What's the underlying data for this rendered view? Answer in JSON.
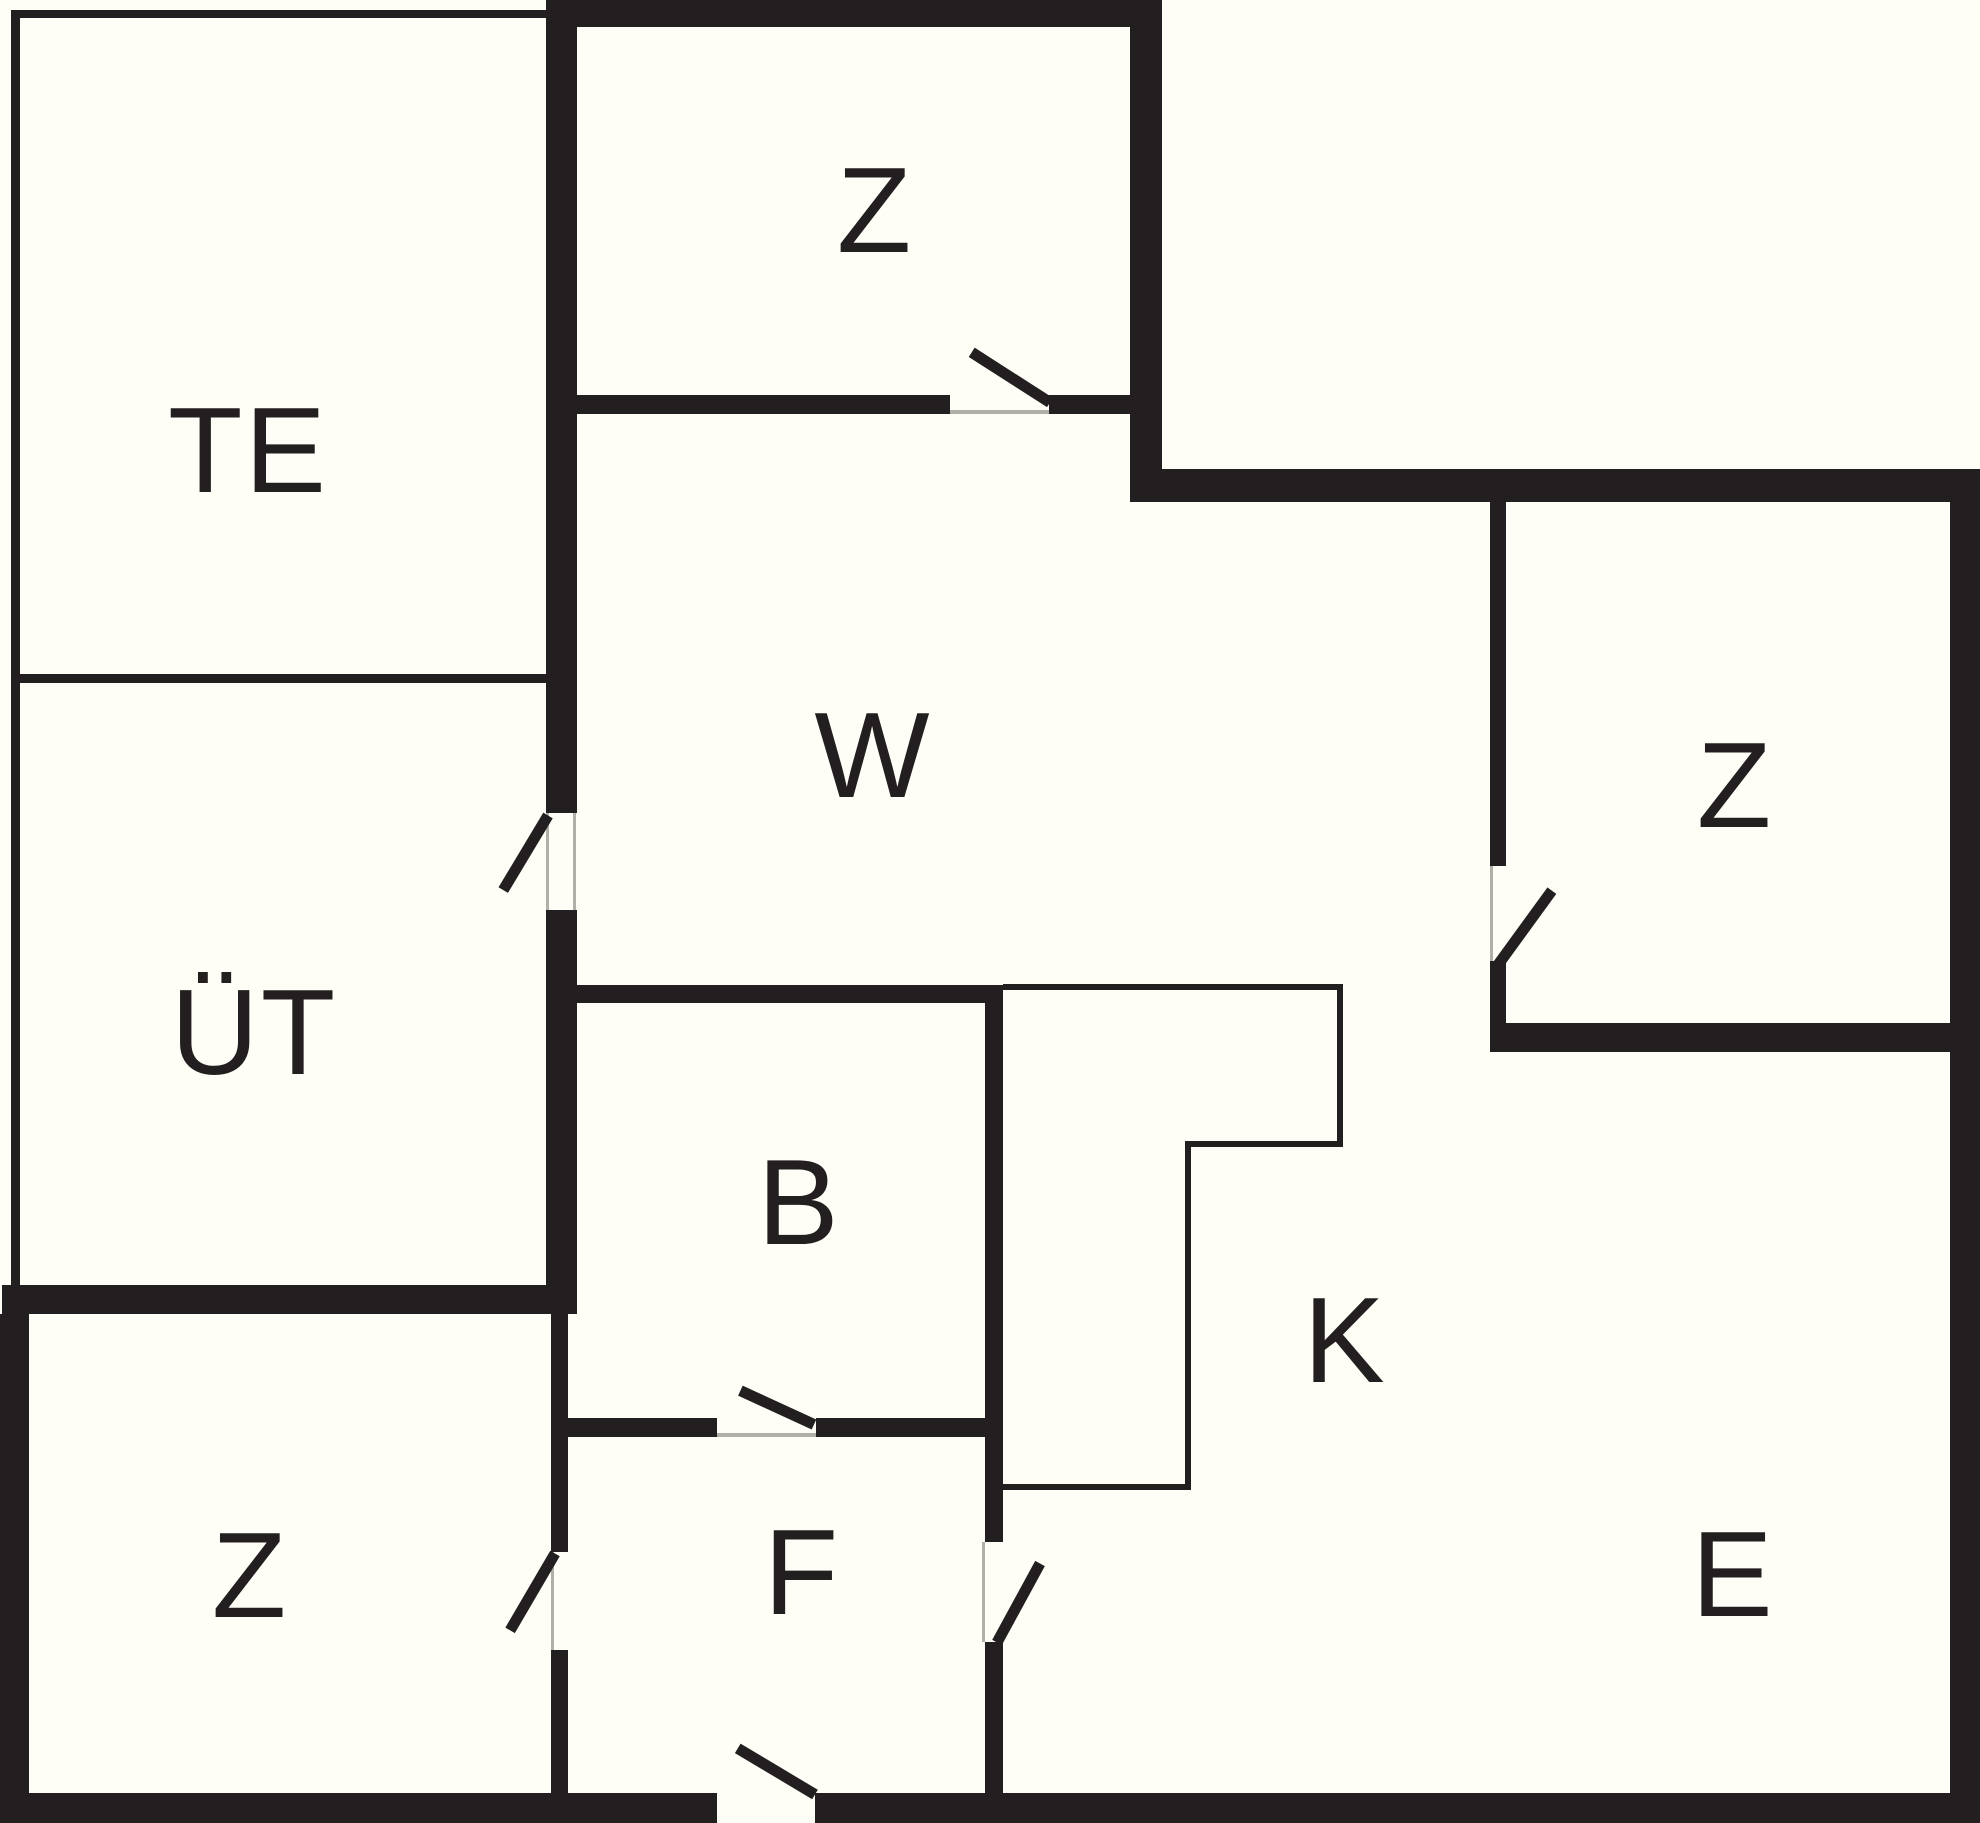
{
  "canvas": {
    "width": 1980,
    "height": 1823,
    "background_color": "#fffef6",
    "ink_color": "#231f20",
    "faint_color": "#b0b0a8",
    "door_swing_thickness": 11
  },
  "rooms": [
    {
      "id": "te",
      "label": "TE",
      "x": 248,
      "y": 450
    },
    {
      "id": "z-top",
      "label": "Z",
      "x": 875,
      "y": 210
    },
    {
      "id": "w",
      "label": "W",
      "x": 873,
      "y": 755
    },
    {
      "id": "z-right",
      "label": "Z",
      "x": 1735,
      "y": 785
    },
    {
      "id": "ut",
      "label": "ÜT",
      "x": 254,
      "y": 1032
    },
    {
      "id": "b",
      "label": "B",
      "x": 799,
      "y": 1202
    },
    {
      "id": "k",
      "label": "K",
      "x": 1345,
      "y": 1340
    },
    {
      "id": "z-bottom",
      "label": "Z",
      "x": 250,
      "y": 1575
    },
    {
      "id": "f",
      "label": "F",
      "x": 802,
      "y": 1572
    },
    {
      "id": "e",
      "label": "E",
      "x": 1733,
      "y": 1574
    }
  ],
  "walls": [
    {
      "name": "outer-wall-top",
      "x": 546,
      "y": 0,
      "w": 616,
      "h": 27
    },
    {
      "name": "wall-te-ztop",
      "x": 546,
      "y": 0,
      "w": 31,
      "h": 813
    },
    {
      "name": "wall-w-left-lower",
      "x": 546,
      "y": 910,
      "w": 31,
      "h": 404
    },
    {
      "name": "wall-ztop-right",
      "x": 1130,
      "y": 0,
      "w": 32,
      "h": 502
    },
    {
      "name": "wall-ztop-bottom-left",
      "x": 577,
      "y": 395,
      "w": 373,
      "h": 19
    },
    {
      "name": "wall-ztop-bottom-right",
      "x": 1049,
      "y": 395,
      "w": 81,
      "h": 19
    },
    {
      "name": "outer-wall-topright",
      "x": 1130,
      "y": 469,
      "w": 850,
      "h": 33
    },
    {
      "name": "outer-wall-right",
      "x": 1950,
      "y": 469,
      "w": 30,
      "h": 1354
    },
    {
      "name": "wall-zright-left-upper",
      "x": 1490,
      "y": 502,
      "w": 16,
      "h": 364
    },
    {
      "name": "wall-zright-left-lower",
      "x": 1490,
      "y": 961,
      "w": 16,
      "h": 91
    },
    {
      "name": "wall-zright-bottom",
      "x": 1490,
      "y": 1023,
      "w": 460,
      "h": 29
    },
    {
      "name": "wall-ut-bottom",
      "x": 2,
      "y": 1285,
      "w": 575,
      "h": 29
    },
    {
      "name": "outer-wall-left-bottom",
      "x": 0,
      "y": 1314,
      "w": 29,
      "h": 509
    },
    {
      "name": "wall-zbottom-f-upper",
      "x": 551,
      "y": 1314,
      "w": 17,
      "h": 238
    },
    {
      "name": "wall-zbottom-f-lower",
      "x": 551,
      "y": 1650,
      "w": 17,
      "h": 143
    },
    {
      "name": "wall-b-top",
      "x": 577,
      "y": 985,
      "w": 426,
      "h": 18
    },
    {
      "name": "wall-b-right",
      "x": 985,
      "y": 985,
      "w": 18,
      "h": 557
    },
    {
      "name": "wall-f-right-lower",
      "x": 985,
      "y": 1642,
      "w": 18,
      "h": 151
    },
    {
      "name": "wall-b-bottom-left",
      "x": 568,
      "y": 1418,
      "w": 149,
      "h": 19
    },
    {
      "name": "wall-b-bottom-right",
      "x": 816,
      "y": 1418,
      "w": 187,
      "h": 19
    },
    {
      "name": "outer-wall-bottom-left",
      "x": 0,
      "y": 1793,
      "w": 717,
      "h": 30
    },
    {
      "name": "outer-wall-bottom-right",
      "x": 815,
      "y": 1793,
      "w": 1165,
      "h": 30
    }
  ],
  "structure_lines": [
    {
      "name": "terrace-line-left",
      "x": 11,
      "y": 10,
      "w": 9,
      "h": 1275
    },
    {
      "name": "terrace-line-top",
      "x": 11,
      "y": 10,
      "w": 535,
      "h": 8
    },
    {
      "name": "terrace-line-te-ut",
      "x": 11,
      "y": 674,
      "w": 540,
      "h": 9
    }
  ],
  "counter_lines": [
    {
      "name": "counter-line-top",
      "x": 1003,
      "y": 984,
      "w": 340,
      "h": 6
    },
    {
      "name": "counter-line-right",
      "x": 1337,
      "y": 984,
      "w": 6,
      "h": 163
    },
    {
      "name": "counter-line-mid-h",
      "x": 1185,
      "y": 1141,
      "w": 158,
      "h": 6
    },
    {
      "name": "counter-line-mid-v",
      "x": 1185,
      "y": 1141,
      "w": 6,
      "h": 349
    },
    {
      "name": "counter-line-bottom",
      "x": 997,
      "y": 1484,
      "w": 194,
      "h": 6
    }
  ],
  "gap_edges": [
    {
      "name": "doorgap-edge-ztop",
      "x": 950,
      "y": 410,
      "w": 99,
      "h": 4
    },
    {
      "name": "doorgap-edge-ut-left",
      "x": 546,
      "y": 813,
      "w": 3,
      "h": 97
    },
    {
      "name": "doorgap-edge-ut-right",
      "x": 573,
      "y": 813,
      "w": 3,
      "h": 97
    },
    {
      "name": "doorgap-edge-zright",
      "x": 1490,
      "y": 866,
      "w": 3,
      "h": 95
    },
    {
      "name": "doorgap-edge-b",
      "x": 717,
      "y": 1433,
      "w": 99,
      "h": 4
    },
    {
      "name": "doorgap-edge-zbottom",
      "x": 551,
      "y": 1552,
      "w": 3,
      "h": 98
    },
    {
      "name": "doorgap-edge-fk",
      "x": 982,
      "y": 1542,
      "w": 3,
      "h": 100
    }
  ],
  "door_swings": [
    {
      "name": "door-swing-ztop",
      "x1": 1050,
      "y1": 402,
      "x2": 972,
      "y2": 352
    },
    {
      "name": "door-swing-ut",
      "x1": 548,
      "y1": 815,
      "x2": 503,
      "y2": 890
    },
    {
      "name": "door-swing-zright",
      "x1": 1496,
      "y1": 967,
      "x2": 1552,
      "y2": 890
    },
    {
      "name": "door-swing-b",
      "x1": 814,
      "y1": 1424,
      "x2": 740,
      "y2": 1390
    },
    {
      "name": "door-swing-zbottom",
      "x1": 555,
      "y1": 1553,
      "x2": 510,
      "y2": 1630
    },
    {
      "name": "door-swing-fk",
      "x1": 997,
      "y1": 1642,
      "x2": 1040,
      "y2": 1563
    },
    {
      "name": "door-swing-entrance",
      "x1": 815,
      "y1": 1794,
      "x2": 738,
      "y2": 1748
    }
  ]
}
